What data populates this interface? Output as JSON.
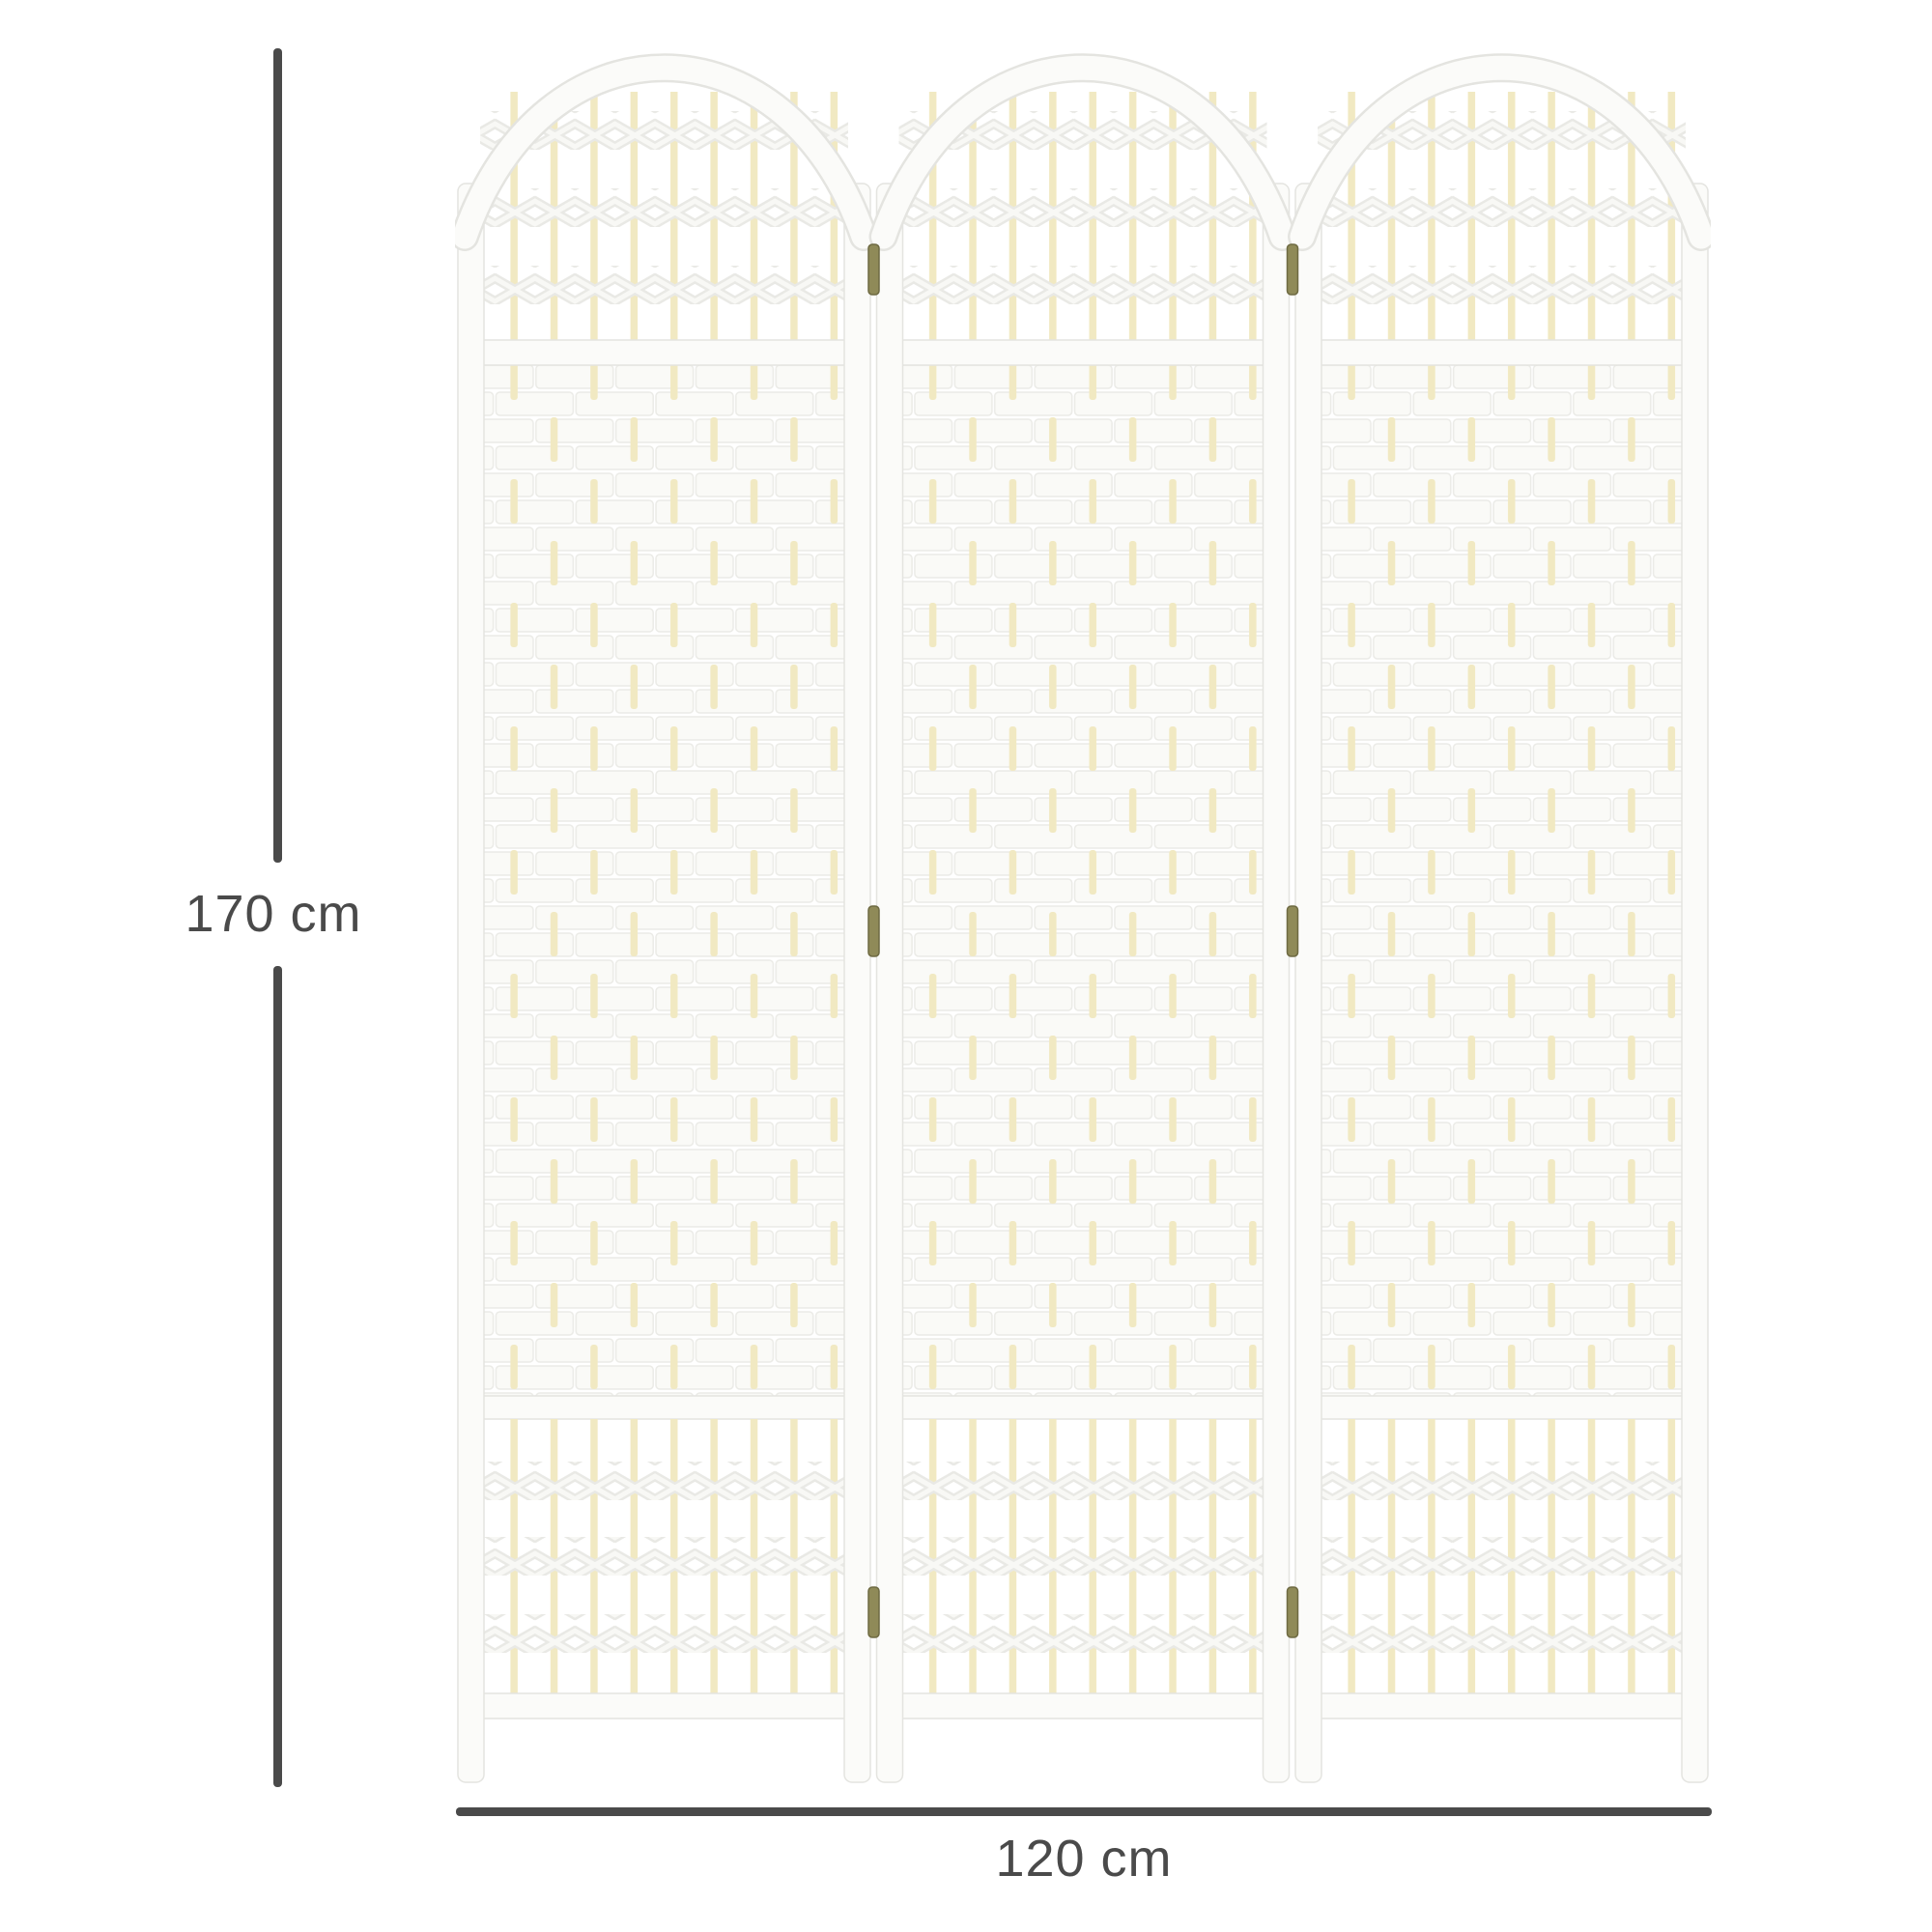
{
  "annotations": {
    "height": {
      "label": "170 cm"
    },
    "width": {
      "label": "120 cm"
    }
  },
  "figure": {
    "panel_count": 3
  },
  "colors": {
    "annotation": "#4a4a4a",
    "frame": "#fbfbf9",
    "frame_edge": "#e4e4e0",
    "dowel": "#f1e9c2",
    "weave": "#fafaf7",
    "weave_edge": "#ebebe7",
    "band": "#e9e9e5",
    "band_hi": "#f8f8f5",
    "hinge": "#8f8a58",
    "hinge_edge": "#6e6a42"
  }
}
